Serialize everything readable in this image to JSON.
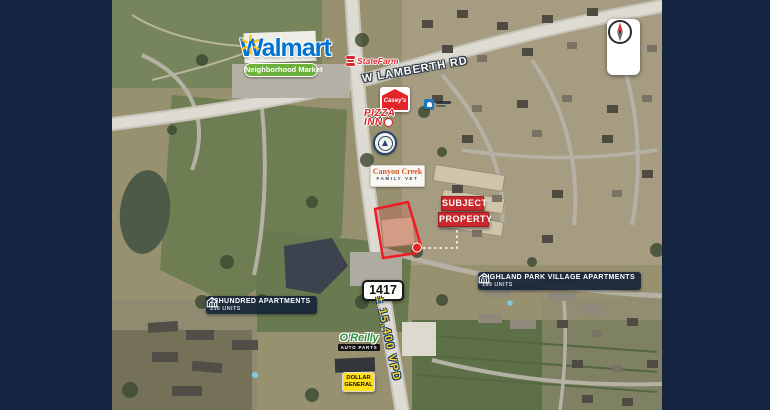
{
  "compass": {
    "north": "N"
  },
  "roads": {
    "lamberth": "W LAMBERTH RD",
    "fm_shield": "1417",
    "traffic_count": "± 15,400 VPD"
  },
  "logos": {
    "walmart": {
      "wordmark": "Walmart",
      "tagline": "Neighborhood Market"
    },
    "state_farm": {
      "wordmark": "StateFarm"
    },
    "caseys": {
      "wordmark": "Casey's"
    },
    "pizza_inn": {
      "line1": "PIZZA",
      "line2": "INN"
    },
    "canyon_creek_vet": {
      "line1": "Canyon Creek",
      "line2": "FAMILY VET"
    },
    "oreilly": {
      "wordmark": "O'Reilly",
      "banner": "AUTO PARTS"
    },
    "dollar_general": {
      "line1": "DOLLAR",
      "line2": "GENERAL"
    }
  },
  "callouts": {
    "subject_property": {
      "line1": "SUBJECT",
      "line2": "PROPERTY"
    },
    "highland_park": {
      "name": "HIGHLAND PARK VILLAGE APARTMENTS",
      "units": "169 UNITS"
    },
    "twentythree_hundred": {
      "name": "23HUNDRED APARTMENTS",
      "units": "216 UNITS"
    }
  },
  "colors": {
    "frame_navy": "#152441",
    "subject_red": "#c9282c",
    "pill_navy": "#17253a",
    "traffic_yellow": "#ffd21c",
    "outline_red": "#ee1c23"
  }
}
